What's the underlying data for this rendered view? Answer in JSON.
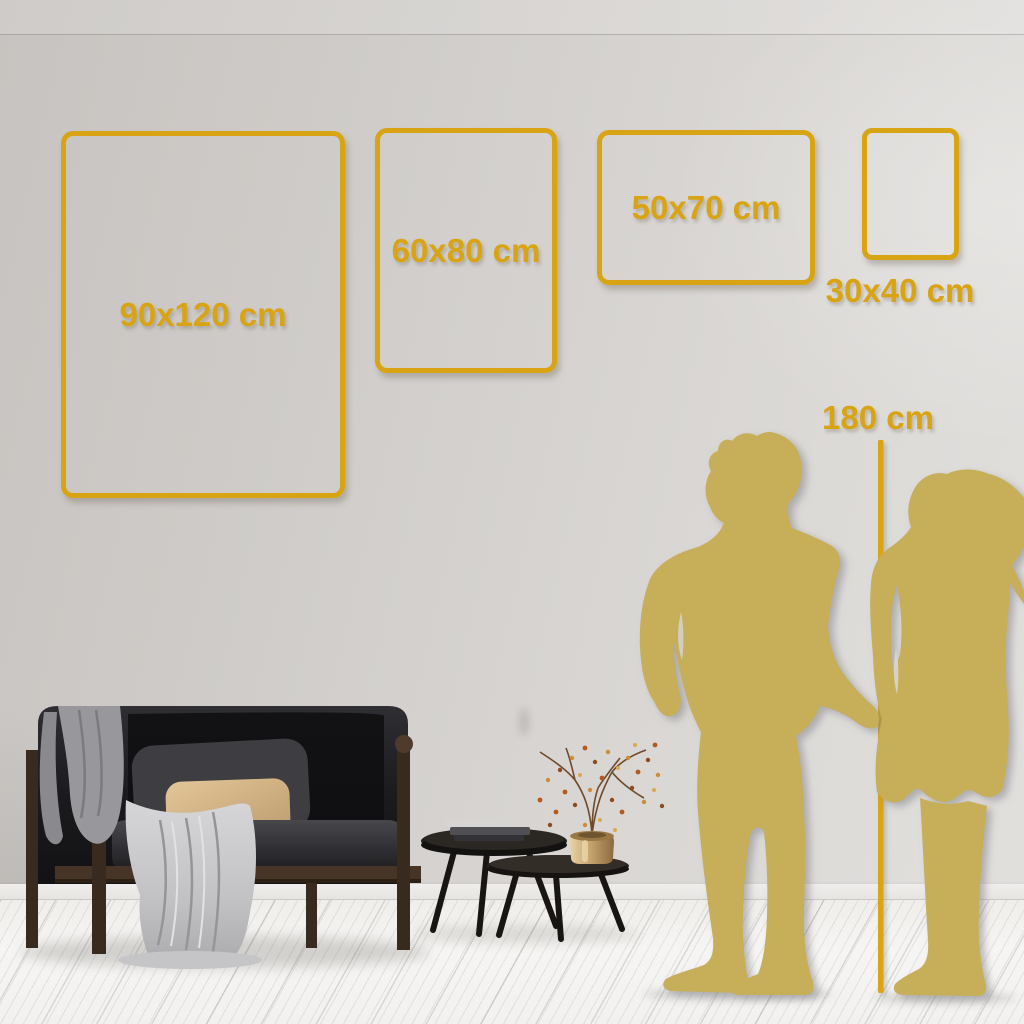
{
  "guide": {
    "kind": "wall-art size comparison guide",
    "colors": {
      "accent_gold": "#D9A413",
      "silhouette_gold": "#C7AE58"
    },
    "size_frames": [
      {
        "label": "90x120 cm",
        "orientation": "portrait",
        "label_position": "center"
      },
      {
        "label": "60x80 cm",
        "orientation": "portrait",
        "label_position": "center"
      },
      {
        "label": "50x70 cm",
        "orientation": "landscape",
        "label_position": "center"
      },
      {
        "label": "30x40 cm",
        "orientation": "portrait",
        "label_position": "below"
      }
    ],
    "height_marker": {
      "label": "180 cm"
    },
    "scene": {
      "figures": [
        "man-silhouette",
        "woman-silhouette"
      ],
      "furniture": [
        "sofa",
        "throw-blanket",
        "gray-cushion",
        "tan-cushion",
        "fabric-drape",
        "nesting-coffee-tables",
        "books",
        "brass-vase",
        "dried-berry-branch"
      ]
    }
  }
}
